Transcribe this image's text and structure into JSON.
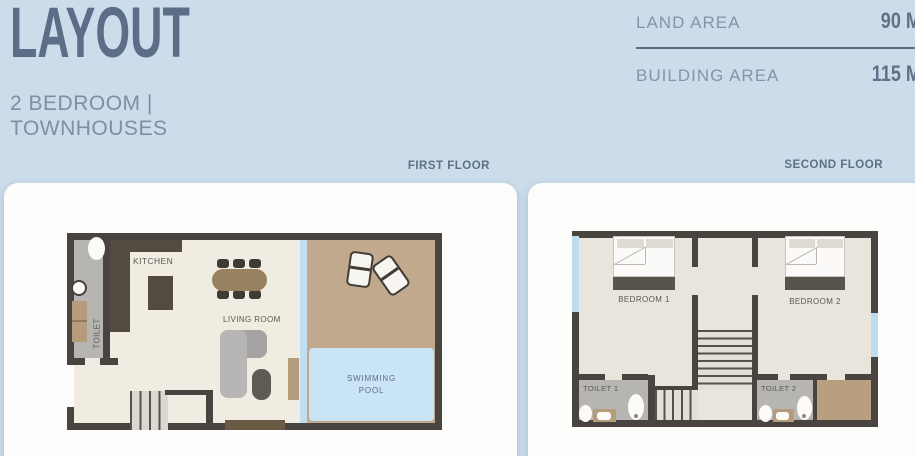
{
  "header": {
    "title": "LAYOUT",
    "subtitle_line1": "2 BEDROOM |",
    "subtitle_line2": "TOWNHOUSES"
  },
  "summary": {
    "land_area_label": "LAND AREA",
    "land_area_value": "90 M",
    "building_area_label": "BUILDING AREA",
    "building_area_value": "115 M"
  },
  "first_floor": {
    "heading": "FIRST FLOOR",
    "labels": {
      "kitchen": "KITCHEN",
      "living_room": "LIVING ROOM",
      "toilet": "TOILET",
      "pool_line1": "SWIMMING",
      "pool_line2": "POOL"
    }
  },
  "second_floor": {
    "heading": "SECOND FLOOR",
    "labels": {
      "bedroom1": "BEDROOM 1",
      "bedroom2": "BEDROOM 2",
      "toilet1": "TOILET 1",
      "toilet2": "TOILET 2"
    }
  },
  "palette": {
    "page_background": "#ccdcea",
    "card_background": "#fdfdfc",
    "heading_text": "#5b6d87",
    "subtitle_text": "#7e8fa0",
    "summary_label": "#8494a6",
    "summary_value": "#5f7188",
    "wall": "#494440",
    "floor1_interior": "#f1ece2",
    "floor2_interior": "#e9e5dc",
    "patio_tan": "#c0a98c",
    "pool_blue": "#c9e4f5",
    "glass_blue": "#bfdef2",
    "bathroom_gray": "#b6b5b1",
    "wood_tan": "#b49c7d",
    "counter_brown": "#544b40"
  }
}
